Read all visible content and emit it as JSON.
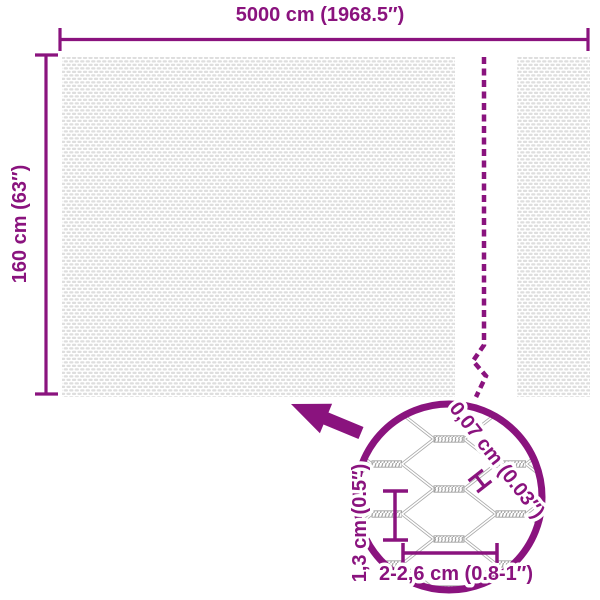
{
  "title": "Mesh fence dimensions diagram",
  "colors": {
    "accent": "#8a137e",
    "mesh_texture_gray": "#dedede",
    "wire_gray": "#a9a9a9"
  },
  "labels": {
    "width": "5000 cm (1968.5″)",
    "height": "160 cm (63″)",
    "wire_thickness": "0,07 cm (0.03″)",
    "mesh_height": "1,3 cm (0.5″)",
    "mesh_width": "2-2,6 cm (0.8-1″)"
  },
  "icons": {
    "zoom_arrow": "thick arrow pointing from magnifier circle to mesh panel",
    "magnifier_circle": "detail zoom circle of hexagonal wire mesh",
    "break_line": "dashed zigzag line indicating omitted length"
  }
}
